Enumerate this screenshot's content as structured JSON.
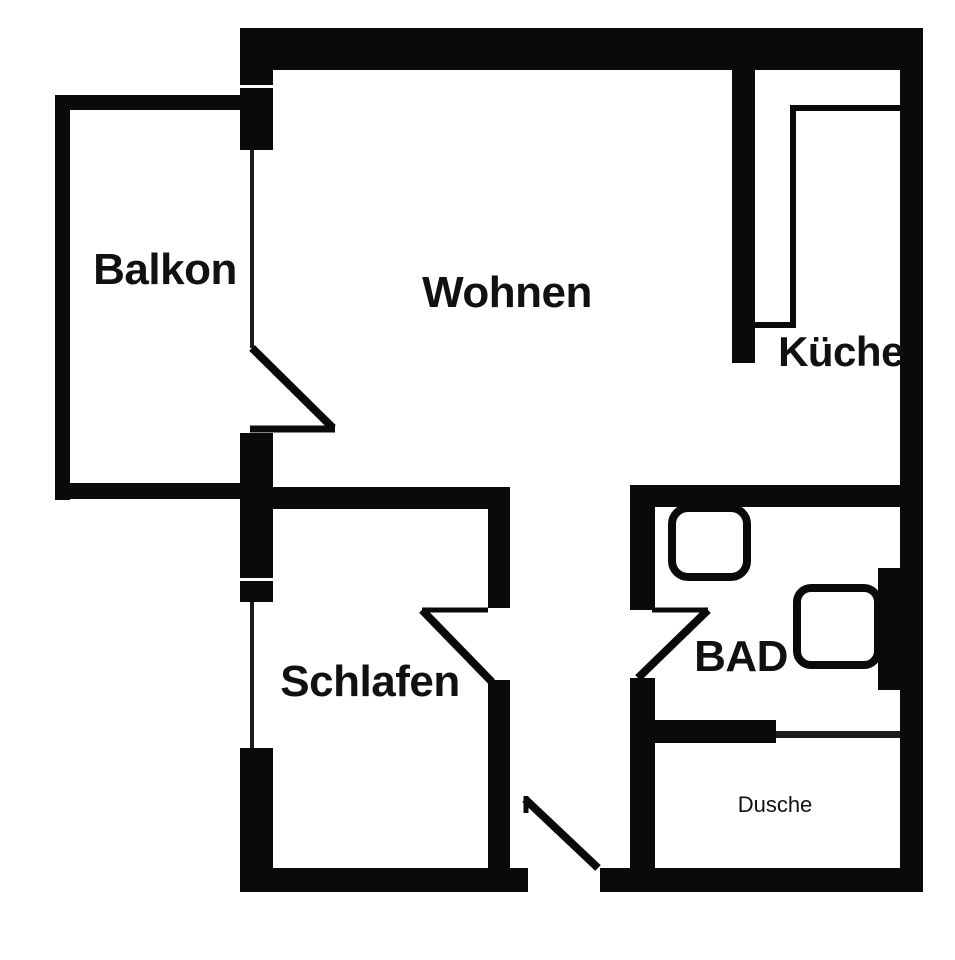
{
  "colors": {
    "background": "#ffffff",
    "wall": "#0a0a0a",
    "thin": "#1c1c1c",
    "text": "#111111"
  },
  "rooms": [
    {
      "name": "balkon",
      "label": "Balkon",
      "cx": 165,
      "cy": 270,
      "font": 44
    },
    {
      "name": "wohnen",
      "label": "Wohnen",
      "cx": 507,
      "cy": 293,
      "font": 44
    },
    {
      "name": "kueche",
      "label": "Küche",
      "cx": 841,
      "cy": 352,
      "font": 42
    },
    {
      "name": "schlafen",
      "label": "Schlafen",
      "cx": 370,
      "cy": 682,
      "font": 44
    },
    {
      "name": "bad",
      "label": "BAD",
      "cx": 741,
      "cy": 657,
      "font": 44
    },
    {
      "name": "dusche",
      "label": "Dusche",
      "cx": 775,
      "cy": 805,
      "font": 22
    }
  ],
  "walls": [
    {
      "name": "exterior-top-wall",
      "x": 240,
      "y": 28,
      "w": 683,
      "h": 42
    },
    {
      "name": "exterior-right-wall",
      "x": 900,
      "y": 28,
      "w": 23,
      "h": 864
    },
    {
      "name": "exterior-left-wall-upper",
      "x": 240,
      "y": 70,
      "w": 33,
      "h": 15
    },
    {
      "name": "balcony-door-jamb",
      "x": 240,
      "y": 88,
      "w": 33,
      "h": 62
    },
    {
      "name": "exterior-left-wall-middle",
      "x": 240,
      "y": 433,
      "w": 33,
      "h": 145
    },
    {
      "name": "schlafen-window-jamb-top",
      "x": 240,
      "y": 581,
      "w": 33,
      "h": 21
    },
    {
      "name": "exterior-left-wall-lower",
      "x": 240,
      "y": 748,
      "w": 33,
      "h": 144
    },
    {
      "name": "wohnen-schlafen-wall",
      "x": 268,
      "y": 487,
      "w": 242,
      "h": 22
    },
    {
      "name": "schlafen-east-wall-upper",
      "x": 488,
      "y": 487,
      "w": 22,
      "h": 121
    },
    {
      "name": "schlafen-east-wall-lower",
      "x": 488,
      "y": 680,
      "w": 22,
      "h": 188
    },
    {
      "name": "bad-north-wall",
      "x": 630,
      "y": 485,
      "w": 270,
      "h": 22
    },
    {
      "name": "bad-west-wall-upper",
      "x": 630,
      "y": 485,
      "w": 25,
      "h": 125
    },
    {
      "name": "bad-west-wall-lower",
      "x": 630,
      "y": 678,
      "w": 25,
      "h": 190
    },
    {
      "name": "dusche-partition-wall",
      "x": 640,
      "y": 720,
      "w": 136,
      "h": 23
    },
    {
      "name": "duct-block",
      "x": 878,
      "y": 568,
      "w": 24,
      "h": 122
    },
    {
      "name": "kueche-divider-wall",
      "x": 732,
      "y": 70,
      "w": 23,
      "h": 293
    },
    {
      "name": "exterior-bottom-wall-west",
      "x": 240,
      "y": 868,
      "w": 288,
      "h": 24
    },
    {
      "name": "exterior-bottom-wall-east",
      "x": 600,
      "y": 868,
      "w": 323,
      "h": 24
    },
    {
      "name": "balcony-west-wall",
      "x": 55,
      "y": 95,
      "w": 15,
      "h": 405
    },
    {
      "name": "balcony-north-wall",
      "x": 55,
      "y": 95,
      "w": 187,
      "h": 15
    },
    {
      "name": "balcony-south-wall",
      "x": 55,
      "y": 483,
      "w": 187,
      "h": 16
    }
  ],
  "windows": [
    {
      "name": "balcony-door-glass",
      "x": 250,
      "y": 150,
      "w": 4,
      "h": 198
    },
    {
      "name": "schlafen-window-glass",
      "x": 250,
      "y": 602,
      "w": 4,
      "h": 146
    },
    {
      "name": "dusche-glass-partition",
      "x": 776,
      "y": 731,
      "w": 124,
      "h": 7
    }
  ],
  "doors": [
    {
      "name": "balcony-door-swing",
      "segments": [
        {
          "x1": 252,
          "y1": 348,
          "x2": 333,
          "y2": 428,
          "w": 8
        },
        {
          "x1": 250,
          "y1": 429,
          "x2": 335,
          "y2": 429,
          "w": 7
        }
      ]
    },
    {
      "name": "schlafen-door-swing",
      "segments": [
        {
          "x1": 422,
          "y1": 610,
          "x2": 488,
          "y2": 610,
          "w": 5
        },
        {
          "x1": 422,
          "y1": 610,
          "x2": 492,
          "y2": 682,
          "w": 8
        }
      ]
    },
    {
      "name": "bad-door-swing",
      "segments": [
        {
          "x1": 652,
          "y1": 610,
          "x2": 708,
          "y2": 610,
          "w": 5
        },
        {
          "x1": 708,
          "y1": 610,
          "x2": 638,
          "y2": 678,
          "w": 8
        }
      ]
    },
    {
      "name": "entry-door-swing",
      "segments": [
        {
          "x1": 526,
          "y1": 796,
          "x2": 526,
          "y2": 813,
          "w": 5
        },
        {
          "x1": 525,
          "y1": 799,
          "x2": 598,
          "y2": 868,
          "w": 8
        }
      ]
    }
  ],
  "fixtures": [
    {
      "name": "toilet",
      "x": 672,
      "y": 508,
      "w": 75,
      "h": 69,
      "rx": 16,
      "stroke": 8
    },
    {
      "name": "sink",
      "x": 797,
      "y": 588,
      "w": 81,
      "h": 77,
      "rx": 14,
      "stroke": 8
    }
  ],
  "counter": {
    "name": "kitchen-counter",
    "points": "755,325 793,325 793,108 900,108",
    "stroke": 6
  }
}
